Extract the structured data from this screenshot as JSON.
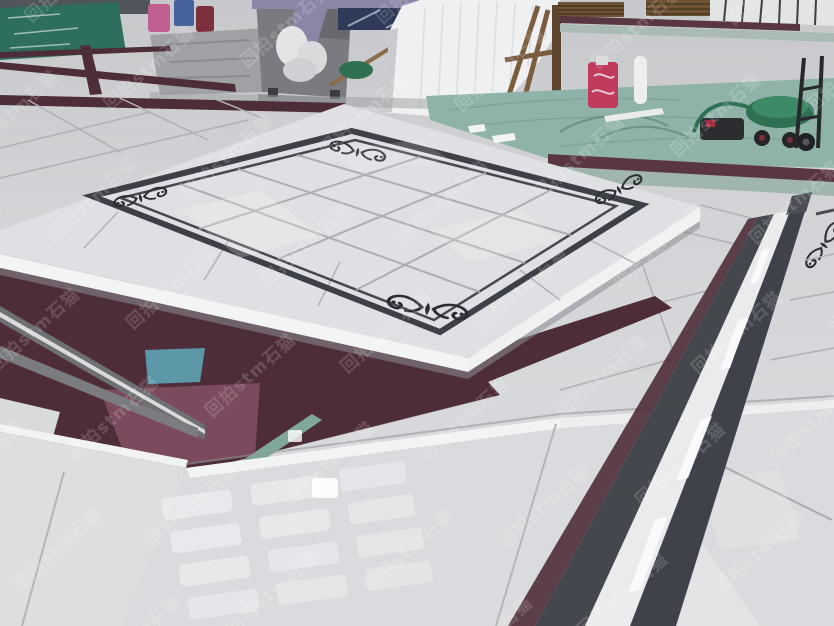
{
  "watermark": {
    "text": "回拍stm石猫",
    "brand_latin": "stm",
    "brand_cjk": "石猫",
    "color": "#ffffff",
    "opacity": "0.16",
    "angle_deg": -42
  },
  "palette": {
    "floor_far": "#c7c8cb",
    "floor_near": "#dcdde0",
    "platform_tile": "#dfe0e3",
    "grid_line": "#a7a9ad",
    "border_granite": "#3d4046",
    "border_inner": "#46494f",
    "ornament": "#2b2e34",
    "bevel_white": "#eff1f2",
    "carpet_dark": "#4e2d3a",
    "carpet_magenta": "#7c4a5e",
    "patch_teal": "#5d98a8",
    "verdigris": "#7fa89a",
    "strip_gray": "#6e7074",
    "strip_stripe": "#d9dbdd",
    "tarp_teal": "#8fb3a9",
    "foam_white": "#eef0f1",
    "wood_brown": "#6e5335",
    "machine_gray": "#797b80",
    "column_purple": "#8d85a6",
    "banner_blue": "#2e3a57",
    "mat_green": "#2e6e5e",
    "basin_green": "#2f7052",
    "bag_red": "#c03a5c",
    "slab_white": "#e2e4e6",
    "handtruck_black": "#26282c",
    "right_strip_dark": "#44474d",
    "right_strip_white": "#e9ebed"
  }
}
